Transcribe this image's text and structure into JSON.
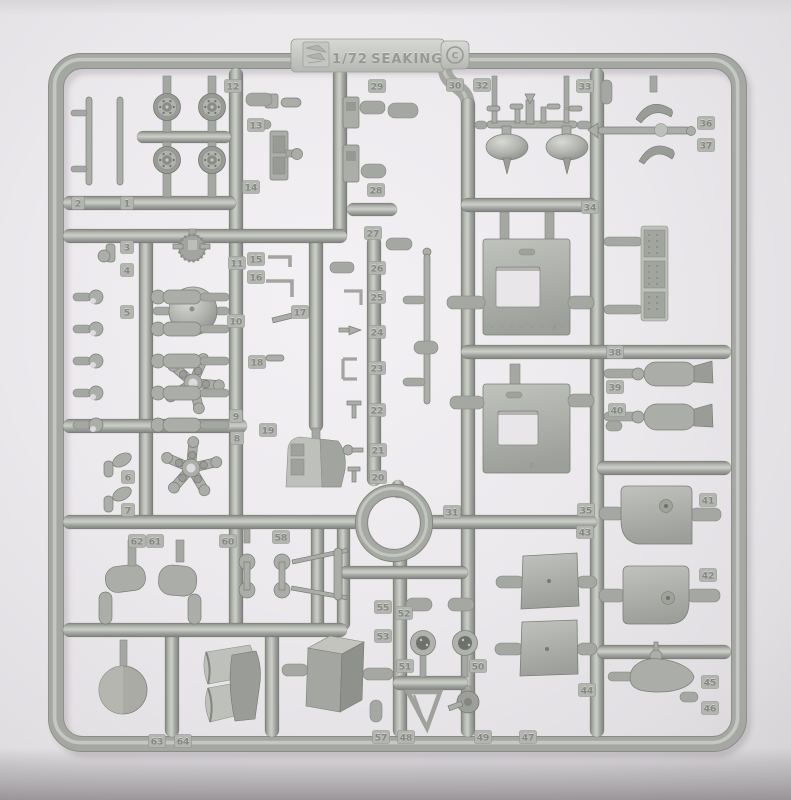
{
  "molding_tab": {
    "scale": "1/72",
    "kit_name": "SEAKING",
    "copyright_mark": "C",
    "logo": "manufacturer-logo-emboss"
  },
  "door_panel_mark": "F",
  "colors": {
    "background": "#eeecef",
    "background_edge": "#d5d3d6",
    "plastic": "#a7a9a4",
    "plastic_highlight": "#c9cbc6",
    "plastic_shadow": "#82847f",
    "tag_face": "#b3b5b0",
    "emboss_dark": "#858782",
    "emboss_light": "#cfd1cc"
  },
  "part_number_tags": [
    {
      "n": "1",
      "x": 127,
      "y": 203
    },
    {
      "n": "2",
      "x": 78,
      "y": 203
    },
    {
      "n": "3",
      "x": 127,
      "y": 247
    },
    {
      "n": "4",
      "x": 127,
      "y": 270
    },
    {
      "n": "5",
      "x": 127,
      "y": 312
    },
    {
      "n": "6",
      "x": 128,
      "y": 477
    },
    {
      "n": "7",
      "x": 128,
      "y": 510
    },
    {
      "n": "8",
      "x": 237,
      "y": 438
    },
    {
      "n": "9",
      "x": 236,
      "y": 416
    },
    {
      "n": "10",
      "x": 236,
      "y": 321
    },
    {
      "n": "11",
      "x": 237,
      "y": 263
    },
    {
      "n": "12",
      "x": 233,
      "y": 86
    },
    {
      "n": "13",
      "x": 256,
      "y": 125
    },
    {
      "n": "14",
      "x": 251,
      "y": 187
    },
    {
      "n": "15",
      "x": 256,
      "y": 259
    },
    {
      "n": "16",
      "x": 256,
      "y": 277
    },
    {
      "n": "17",
      "x": 300,
      "y": 312
    },
    {
      "n": "18",
      "x": 257,
      "y": 362
    },
    {
      "n": "19",
      "x": 268,
      "y": 430
    },
    {
      "n": "20",
      "x": 378,
      "y": 477
    },
    {
      "n": "21",
      "x": 378,
      "y": 450
    },
    {
      "n": "22",
      "x": 377,
      "y": 410
    },
    {
      "n": "23",
      "x": 377,
      "y": 368
    },
    {
      "n": "24",
      "x": 377,
      "y": 332
    },
    {
      "n": "25",
      "x": 377,
      "y": 297
    },
    {
      "n": "26",
      "x": 377,
      "y": 268
    },
    {
      "n": "27",
      "x": 373,
      "y": 233
    },
    {
      "n": "28",
      "x": 376,
      "y": 190
    },
    {
      "n": "29",
      "x": 377,
      "y": 86
    },
    {
      "n": "30",
      "x": 455,
      "y": 85
    },
    {
      "n": "31",
      "x": 452,
      "y": 512
    },
    {
      "n": "32",
      "x": 482,
      "y": 85
    },
    {
      "n": "33",
      "x": 585,
      "y": 86
    },
    {
      "n": "34",
      "x": 590,
      "y": 207
    },
    {
      "n": "35",
      "x": 586,
      "y": 510
    },
    {
      "n": "36",
      "x": 706,
      "y": 123
    },
    {
      "n": "37",
      "x": 706,
      "y": 145
    },
    {
      "n": "38",
      "x": 615,
      "y": 352
    },
    {
      "n": "39",
      "x": 615,
      "y": 387
    },
    {
      "n": "40",
      "x": 617,
      "y": 410
    },
    {
      "n": "41",
      "x": 708,
      "y": 500
    },
    {
      "n": "42",
      "x": 708,
      "y": 575
    },
    {
      "n": "43",
      "x": 585,
      "y": 532
    },
    {
      "n": "44",
      "x": 587,
      "y": 690
    },
    {
      "n": "45",
      "x": 710,
      "y": 682
    },
    {
      "n": "46",
      "x": 710,
      "y": 708
    },
    {
      "n": "47",
      "x": 528,
      "y": 737
    },
    {
      "n": "48",
      "x": 406,
      "y": 737
    },
    {
      "n": "49",
      "x": 483,
      "y": 737
    },
    {
      "n": "50",
      "x": 478,
      "y": 666
    },
    {
      "n": "51",
      "x": 405,
      "y": 666
    },
    {
      "n": "52",
      "x": 404,
      "y": 613
    },
    {
      "n": "53",
      "x": 383,
      "y": 636
    },
    {
      "n": "55",
      "x": 383,
      "y": 607
    },
    {
      "n": "57",
      "x": 381,
      "y": 737
    },
    {
      "n": "58",
      "x": 281,
      "y": 537
    },
    {
      "n": "60",
      "x": 228,
      "y": 541
    },
    {
      "n": "61",
      "x": 155,
      "y": 541
    },
    {
      "n": "62",
      "x": 137,
      "y": 541
    },
    {
      "n": "63",
      "x": 157,
      "y": 741
    },
    {
      "n": "64",
      "x": 183,
      "y": 741
    }
  ]
}
